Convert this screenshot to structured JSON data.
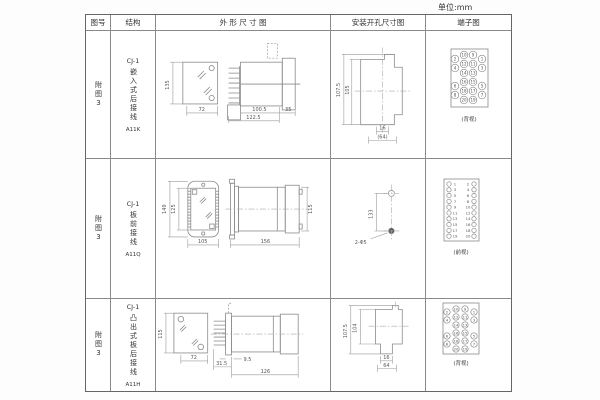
{
  "unit_label": "单位:mm",
  "headers": {
    "fig_no": "图号",
    "structure": "结构",
    "outline": "外 形 尺 寸 图",
    "install": "安装开孔尺寸图",
    "terminal": "端子图"
  },
  "rows": [
    {
      "fig_no": "附图3",
      "model": "CJ-1",
      "structure_name": "嵌入式后接线",
      "code": "A11K",
      "outline": {
        "front_h": "135",
        "front_w": "72",
        "depth1": "100.5",
        "depth2": "122.5",
        "flange": "35"
      },
      "install": {
        "outer_h": "107.5",
        "inner_h": "105",
        "w1": "16",
        "w2": "(64)"
      },
      "terminal": {
        "view_label": "(背视)",
        "cells": [
          "2",
          "10",
          "9",
          "1",
          "4",
          "12",
          "11",
          "3",
          "14",
          "13",
          "6",
          "16",
          "15",
          "5",
          "8",
          "18",
          "17",
          "7",
          "20",
          "19"
        ]
      }
    },
    {
      "fig_no": "附图3",
      "model": "CJ-1",
      "structure_name": "板前接线",
      "code": "A11Q",
      "outline": {
        "front_h": "149",
        "inner_h": "125",
        "front_w": "105",
        "depth": "156",
        "side_h": "115"
      },
      "install": {
        "hole_pitch": "133",
        "hole_label": "2-Φ5"
      },
      "terminal": {
        "view_label": "(前视)",
        "left": [
          "1",
          "3",
          "5",
          "7",
          "9",
          "11",
          "13",
          "15",
          "17",
          "19"
        ],
        "right": [
          "2",
          "4",
          "6",
          "8",
          "10",
          "12",
          "14",
          "16",
          "18",
          "20"
        ]
      }
    },
    {
      "fig_no": "附图3",
      "model": "CJ-1",
      "structure_name": "凸出式板后接线",
      "code": "A11H",
      "outline": {
        "front_h": "115",
        "front_w": "72",
        "d1": "31.5",
        "d2": "9.5",
        "d3": "126"
      },
      "install": {
        "outer_h": "107.5",
        "inner_h": "104",
        "w1": "16",
        "w2": "64"
      },
      "terminal": {
        "view_label": "(背视)",
        "cells": [
          "2",
          "10",
          "9",
          "1",
          "4",
          "12",
          "11",
          "3",
          "14",
          "13",
          "6",
          "16",
          "15",
          "5",
          "8",
          "18",
          "17",
          "7",
          "20",
          "19"
        ]
      }
    }
  ]
}
